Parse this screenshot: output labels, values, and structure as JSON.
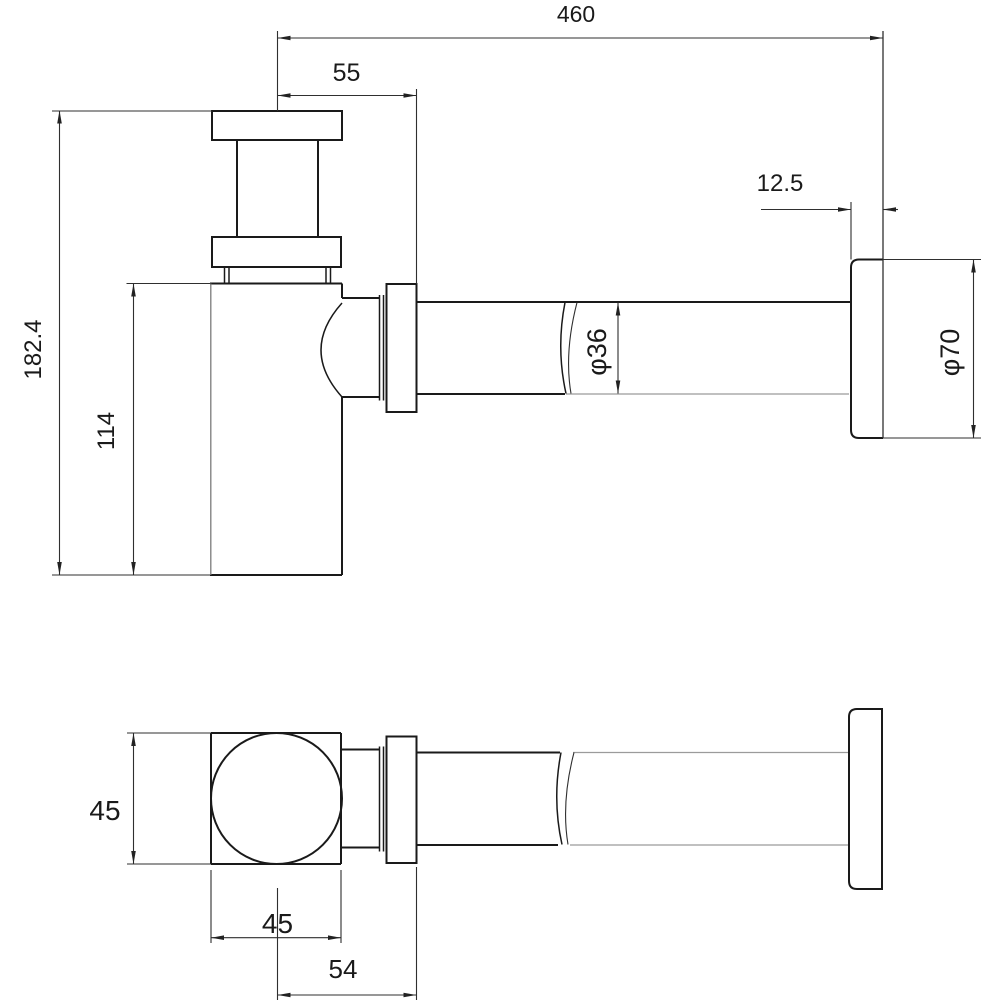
{
  "drawing": {
    "description": "Bottle trap / basin siphon with wall outlet pipe and flange — dimensioned 2-view technical drawing",
    "views": {
      "top": "side elevation",
      "bottom": "plan view"
    }
  },
  "dimensions": {
    "side_view": {
      "overall_length": "460",
      "inlet_to_flange_face": "55",
      "wall_flange_thickness": "12.5",
      "overall_height": "182.4",
      "body_height": "114",
      "pipe_diameter": "φ36",
      "wall_flange_diameter": "φ70"
    },
    "plan_view": {
      "body_depth": "45",
      "body_width": "45",
      "center_to_flange_end": "54"
    }
  },
  "colors": {
    "background": "#ffffff",
    "outline": "#1a1a1a",
    "dimension_lines": "#2f2f2f",
    "hidden_lines": "#9b9b9b"
  }
}
